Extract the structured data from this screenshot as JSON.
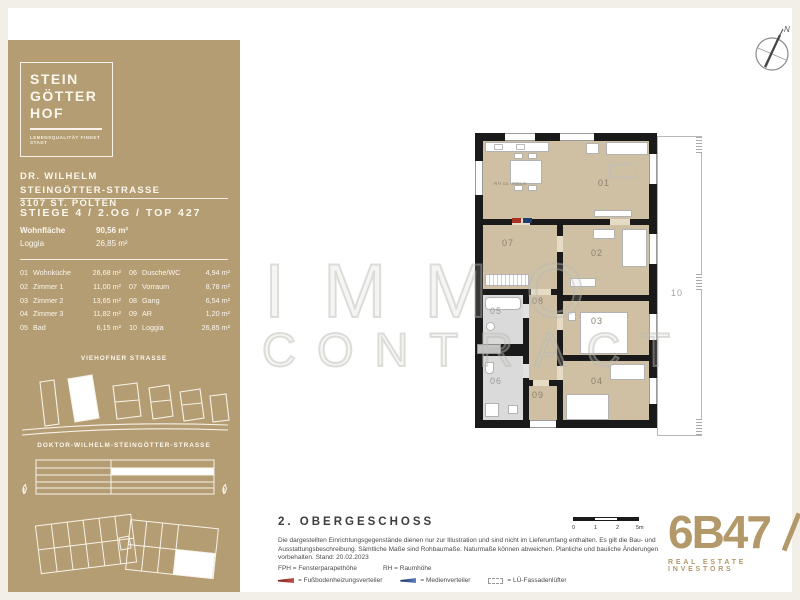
{
  "brand": {
    "logo_lines": [
      "STEIN",
      "GÖTTER",
      "HOF"
    ],
    "tagline": "LEBENSQUALITÄT FINDET STADT"
  },
  "address": {
    "line1": "DR. WILHELM",
    "line2": "STEINGÖTTER-STRASSE",
    "line3": "3107 ST. PÖLTEN"
  },
  "unit": {
    "title": "STIEGE 4 / 2.OG / TOP 427",
    "summary": [
      {
        "label": "Wohnfläche",
        "value": "90,56 m²"
      },
      {
        "label": "Loggia",
        "value": "26,85 m²"
      }
    ],
    "rooms_col1": [
      {
        "no": "01",
        "name": "Wohnküche",
        "area": "26,68 m²"
      },
      {
        "no": "02",
        "name": "Zimmer 1",
        "area": "11,00 m²"
      },
      {
        "no": "03",
        "name": "Zimmer 2",
        "area": "13,65 m²"
      },
      {
        "no": "04",
        "name": "Zimmer 3",
        "area": "11,82 m²"
      },
      {
        "no": "05",
        "name": "Bad",
        "area": "6,15 m²"
      }
    ],
    "rooms_col2": [
      {
        "no": "06",
        "name": "Dusche/WC",
        "area": "4,94 m²"
      },
      {
        "no": "07",
        "name": "Vorraum",
        "area": "8,78 m²"
      },
      {
        "no": "08",
        "name": "Gang",
        "area": "6,54 m²"
      },
      {
        "no": "09",
        "name": "AR",
        "area": "1,20 m²"
      },
      {
        "no": "10",
        "name": "Loggia",
        "area": "26,85 m²"
      }
    ]
  },
  "sitemap": {
    "street_top": "VIEHOFNER STRASSE",
    "street_bottom": "DOKTOR-WILHELM-STEINGÖTTER-STRASSE"
  },
  "plan": {
    "compass_n": "N",
    "room_height_note": "RH ca. 265cm",
    "labels": {
      "r01": "01",
      "r02": "02",
      "r03": "03",
      "r04": "04",
      "r05": "05",
      "r06": "06",
      "r07": "07",
      "r08": "08",
      "r09": "09",
      "r10": "10"
    }
  },
  "watermark": {
    "line1": "IMMO",
    "line2": "CONTRACT"
  },
  "footer": {
    "floor_title": "2. OBERGESCHOSS",
    "disclaimer": "Die dargestellten Einrichtungsgegenstände dienen nur zur Illustration und sind nicht im Lieferumfang enthalten. Es gilt die Bau- und Ausstattungsbeschreibung. Sämtliche Maße sind Rohbaumaße. Naturmaße können abweichen. Planliche und bauliche Änderungen vorbehalten. Stand: 20.02.2023",
    "legend_abbr1": "FPH = Fensterparapethöhe",
    "legend_abbr2": "RH = Raumhöhe",
    "legend_item1": "= Fußbodenheizungsverteiler",
    "legend_item2": "= Medienverteiler",
    "legend_item3": "= LÜ-Fassadenlüfter",
    "scale_labels": {
      "l0": "0",
      "l1": "1",
      "l2": "2",
      "l3": "5m"
    }
  },
  "company": {
    "logo": "6B47",
    "subtitle": "REAL ESTATE INVESTORS"
  },
  "colors": {
    "sidebar_gold": "#b49d73",
    "floor_tan": "#cfc0a3",
    "bath_gray": "#dadada",
    "wall_black": "#1a1a1a",
    "brand_gold": "#b3986a",
    "heating_red": "#a93226",
    "media_blue": "#1f3c74"
  }
}
